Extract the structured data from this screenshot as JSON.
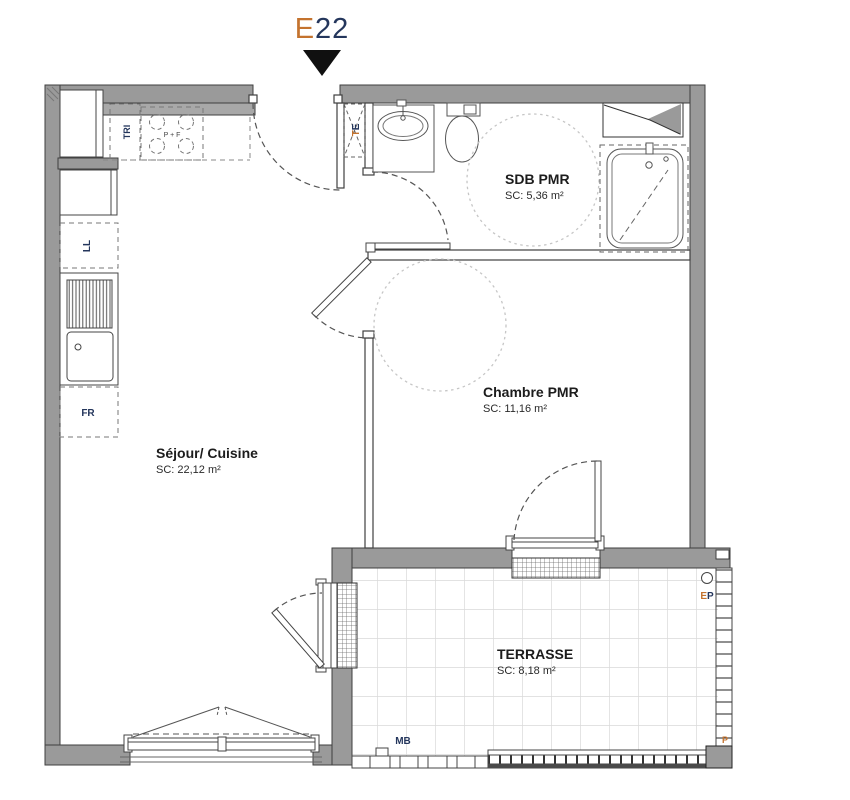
{
  "unit": {
    "letter": "E",
    "number": "22"
  },
  "rooms": {
    "sejour": {
      "name": "Séjour/ Cuisine",
      "area": "SC: 22,12 m²"
    },
    "chambre": {
      "name": "Chambre PMR",
      "area": "SC: 11,16 m²"
    },
    "sdb": {
      "name": "SDB PMR",
      "area": "SC: 5,36 m²"
    },
    "terrasse": {
      "name": "TERRASSE",
      "area": "SC: 8,18 m²"
    }
  },
  "annotations": {
    "tri": "TRI",
    "ll": "LL",
    "fr": "FR",
    "te": [
      "T",
      "E"
    ],
    "stove": "P + F",
    "ep": [
      "E",
      "P"
    ],
    "mb": "MB",
    "pillar": "P"
  },
  "colors": {
    "wall": "#9a9a9a",
    "line_dark": "#3f3f3f",
    "accent_orange": "#c4732e",
    "accent_navy": "#24365c",
    "grid": "#d9d9d9",
    "pmr_circle": "#c6c6c6"
  }
}
